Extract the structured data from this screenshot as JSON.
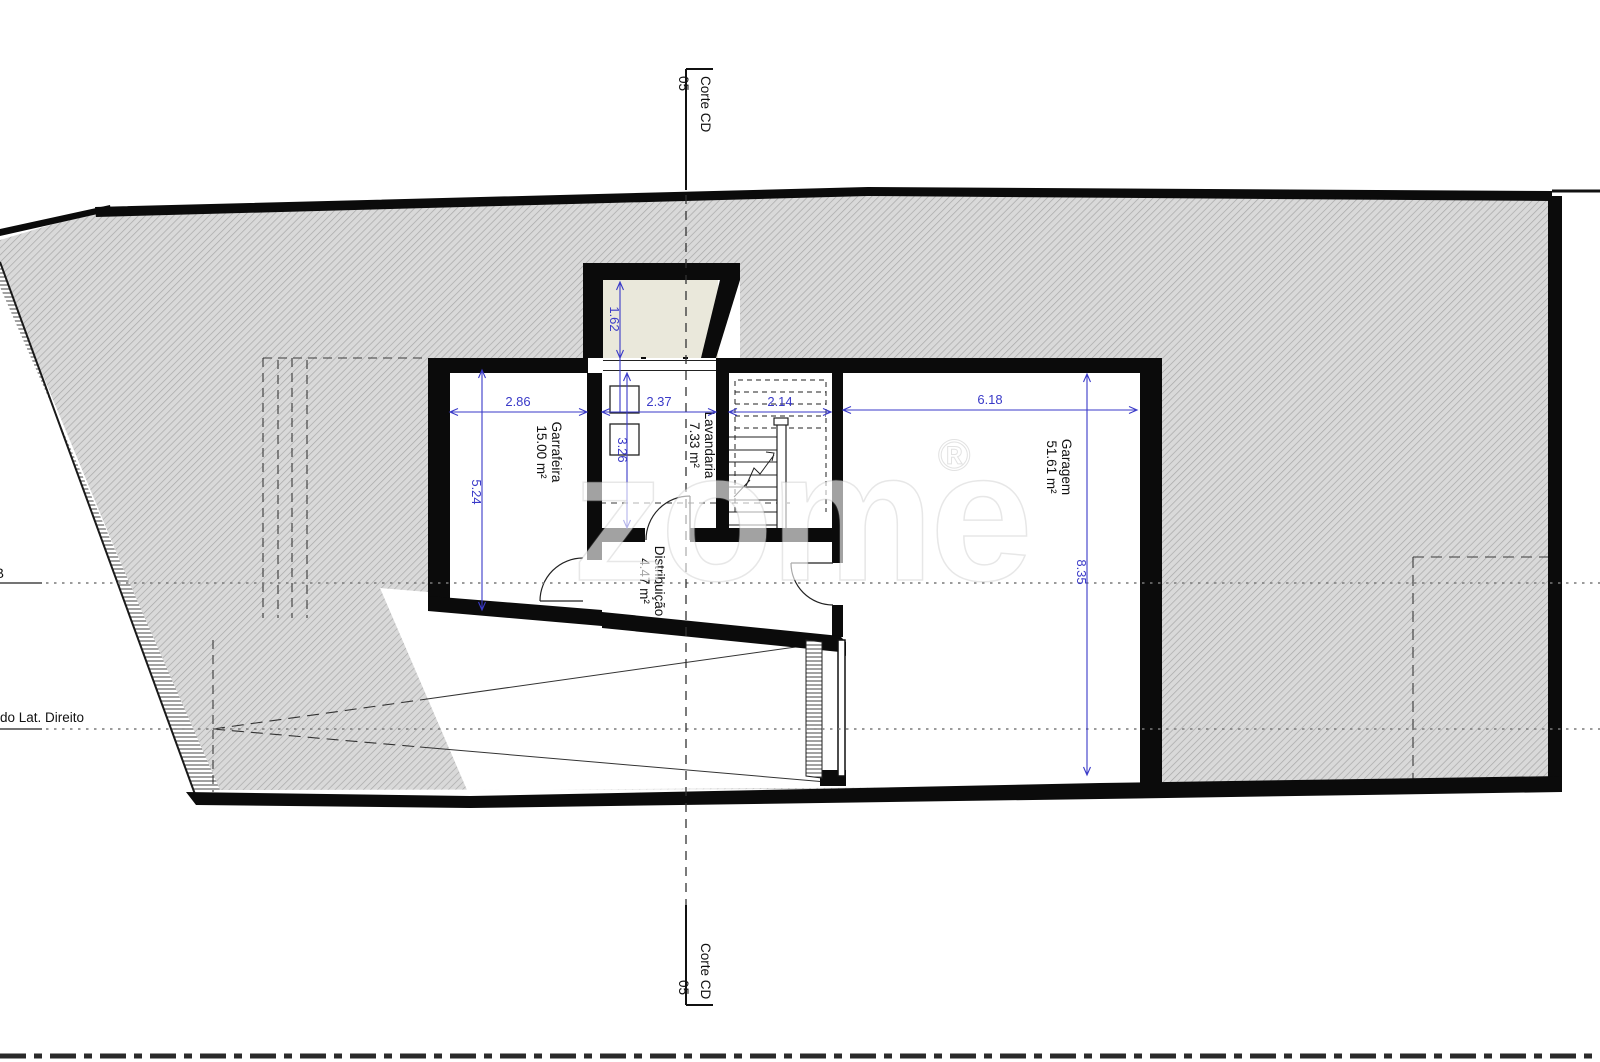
{
  "drawing": {
    "rooms": [
      {
        "name": "Garrafeira",
        "area": "15.00 m²"
      },
      {
        "name": "Lavandaria",
        "area": "7.33 m²"
      },
      {
        "name": "Distribuição",
        "area": "4.47 m²"
      },
      {
        "name": "Garagem",
        "area": "51.61 m²"
      }
    ],
    "dimensions": {
      "garrafeira_width": "2.86",
      "lavandaria_width": "2.37",
      "stairs_width": "2.14",
      "garagem_width": "6.18",
      "garrafeira_depth": "5.24",
      "lavandaria_depth": "3.26",
      "garagem_depth": "8.35",
      "lightwell_depth": "1.62"
    },
    "section_marker": {
      "label": "Corte CD",
      "number": "05"
    },
    "reference_lines": {
      "top_label": "B",
      "bottom_label": "do Lat. Direito"
    },
    "watermark": {
      "text": "zome",
      "registered": "®"
    },
    "colors": {
      "dimension_blue": "#3a3ac8",
      "wall_black": "#0b0b0b",
      "lightwell_fill": "#eae8db",
      "hatch_base": "#d9d9d9",
      "hatch_line": "#a8a8a8",
      "reference_gray": "#7a7a7a"
    }
  }
}
